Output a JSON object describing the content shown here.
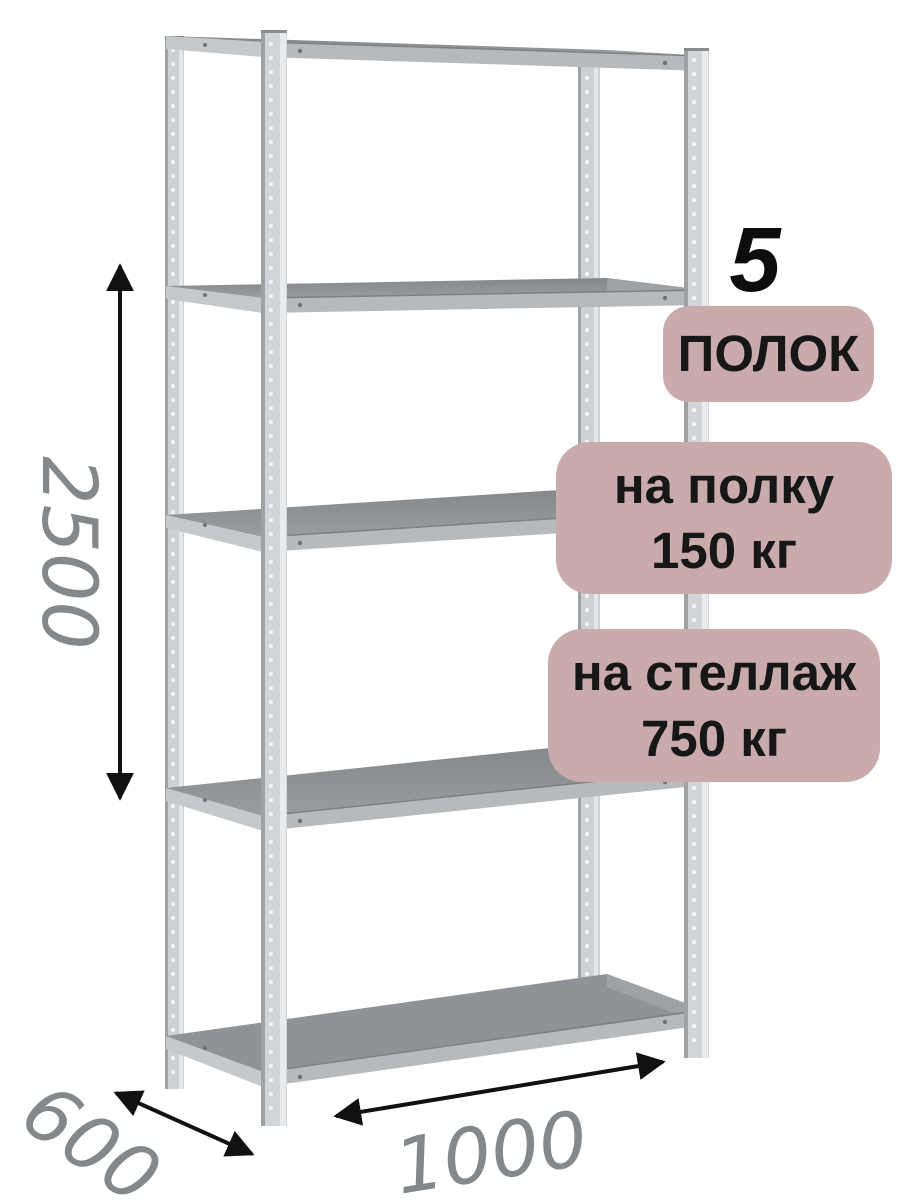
{
  "product": {
    "shelf_count": {
      "number": "5",
      "label": "ПОЛОК"
    },
    "shelf_load": {
      "line1": "на полку",
      "line2": "150 кг"
    },
    "rack_load": {
      "line1": "на стеллаж",
      "line2": "750 кг"
    }
  },
  "dimensions": {
    "height_mm": "2500",
    "depth_mm": "600",
    "width_mm": "1000"
  },
  "colors": {
    "badge_bg": "#c9abab",
    "badge_text": "#171717",
    "dimension_text": "#84888b",
    "arrow": "#111111",
    "metal_body": "#d2d5d7",
    "metal_dark_edge": "#9fa2a5",
    "shelf_surface_back": "#84878a",
    "shelf_surface_front": "#9a9da0",
    "shelf_fascia": "#b7babd",
    "background": "#ffffff"
  }
}
